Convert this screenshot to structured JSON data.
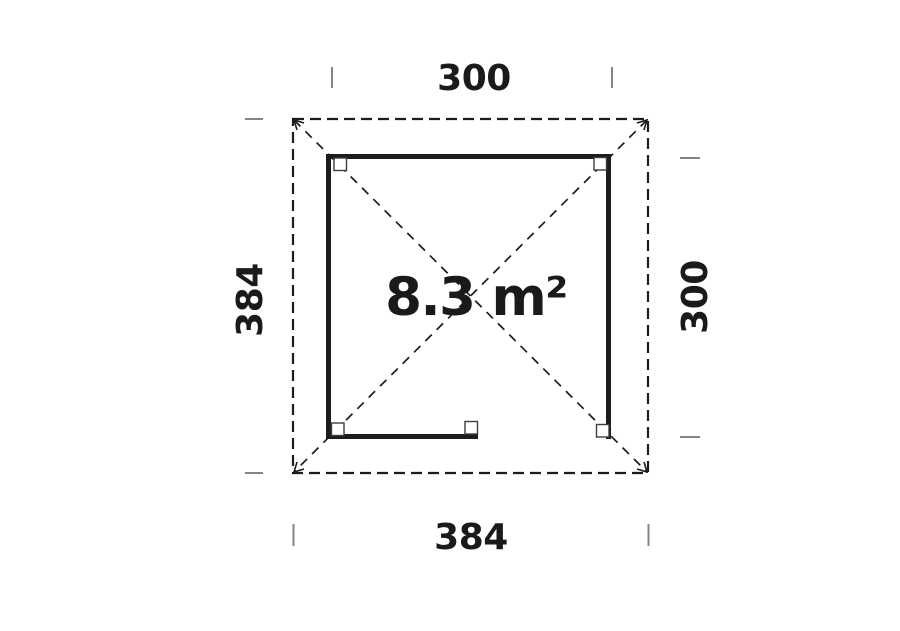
{
  "floor_plan": {
    "area_label": "8.3 m²",
    "dimensions": {
      "top": "300",
      "bottom": "384",
      "left": "384",
      "right": "300"
    },
    "colors": {
      "line": "#1c1c1c",
      "tick": "#848484",
      "text": "#1a1a1a",
      "post_fill": "#ffffff",
      "background": "#ffffff"
    }
  }
}
